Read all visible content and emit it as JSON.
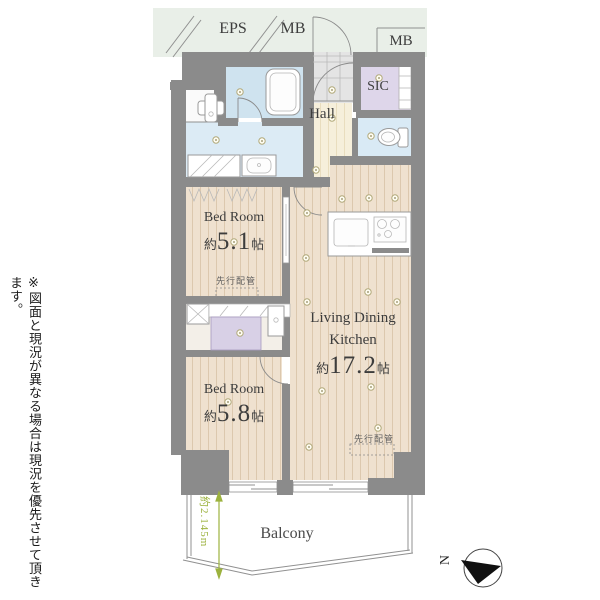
{
  "disclaimer": "※図面と現況が異なる場合は現況を優先させて頂きます。",
  "top_labels": {
    "eps": "EPS",
    "mb_left": "MB",
    "mb_right": "MB"
  },
  "rooms": {
    "hall": {
      "label": "Hall"
    },
    "sic": {
      "label": "SIC"
    },
    "bedroom_upper": {
      "label": "Bed Room",
      "size_prefix": "約",
      "size_num": "5.1",
      "size_suffix": "帖"
    },
    "bedroom_lower": {
      "label": "Bed Room",
      "size_prefix": "約",
      "size_num": "5.8",
      "size_suffix": "帖"
    },
    "ldk": {
      "label_line1": "Living Dining",
      "label_line2": "Kitchen",
      "size_prefix": "約",
      "size_num": "17.2",
      "size_suffix": "帖"
    },
    "balcony": {
      "label": "Balcony"
    }
  },
  "annotations": {
    "piping_upper": "先行配管",
    "piping_lower": "先行配管",
    "balcony_depth": "約2.145m",
    "compass_north": "N"
  },
  "colors": {
    "wall": "#8b8b8b",
    "floor_wood": "#efe1cf",
    "floor_hall": "#f6efdb",
    "bathroom": "#cfe3ef",
    "washroom": "#dcebf5",
    "toilet": "#d9eaf5",
    "sic": "#ded6ea",
    "closet": "#d8d0e6",
    "entrance": "#e4e4e4",
    "eps_strip": "#e9efe8",
    "dimension_green": "#9cb23e"
  }
}
